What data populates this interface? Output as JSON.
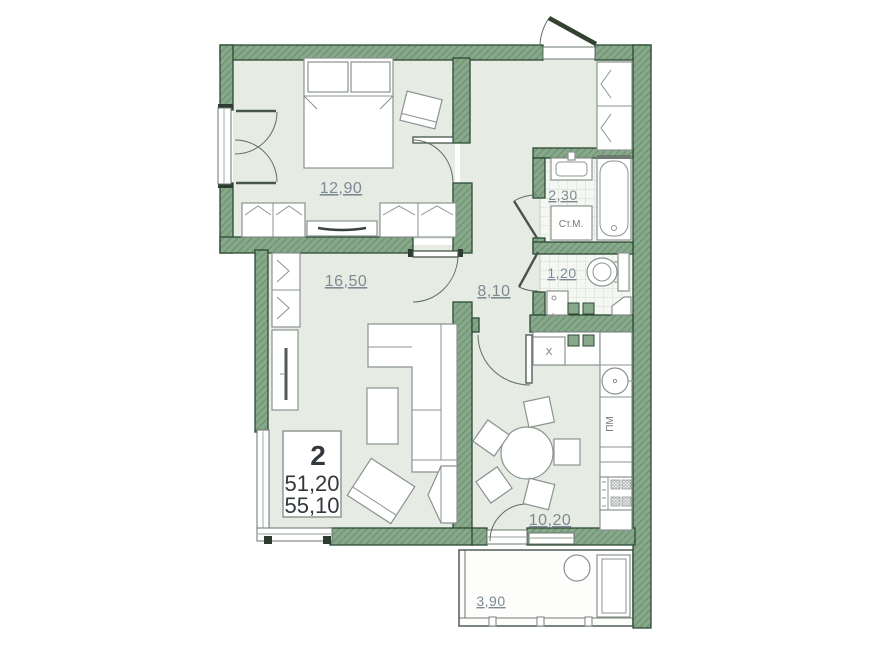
{
  "floor_plan": {
    "info_box": {
      "rooms_count": "2",
      "living_area": "51,20",
      "total_area": "55,10"
    },
    "rooms": {
      "bedroom": {
        "area": "12,90"
      },
      "living_room": {
        "area": "16,50"
      },
      "hallway": {
        "area": "8,10"
      },
      "bathroom": {
        "area": "2,30"
      },
      "wc": {
        "area": "1,20"
      },
      "kitchen": {
        "area": "10,20"
      },
      "balcony": {
        "area": "3,90"
      }
    },
    "appliance_labels": {
      "washing_machine": "Ст.М.",
      "dishwasher": "ПМ",
      "fridge": "X"
    },
    "colors": {
      "wall": "#87a88b",
      "wall_hatch": "#6b9170",
      "wall_outline": "#2c4a33",
      "room_floor": "#e6ece4",
      "tile": "#f4f7f2",
      "tile_line": "#ccd8cb",
      "balcony_floor": "#fdfdfc",
      "furniture_line": "#8b938f",
      "label_color": "#7e8a93",
      "info_text": "#33383c"
    }
  }
}
